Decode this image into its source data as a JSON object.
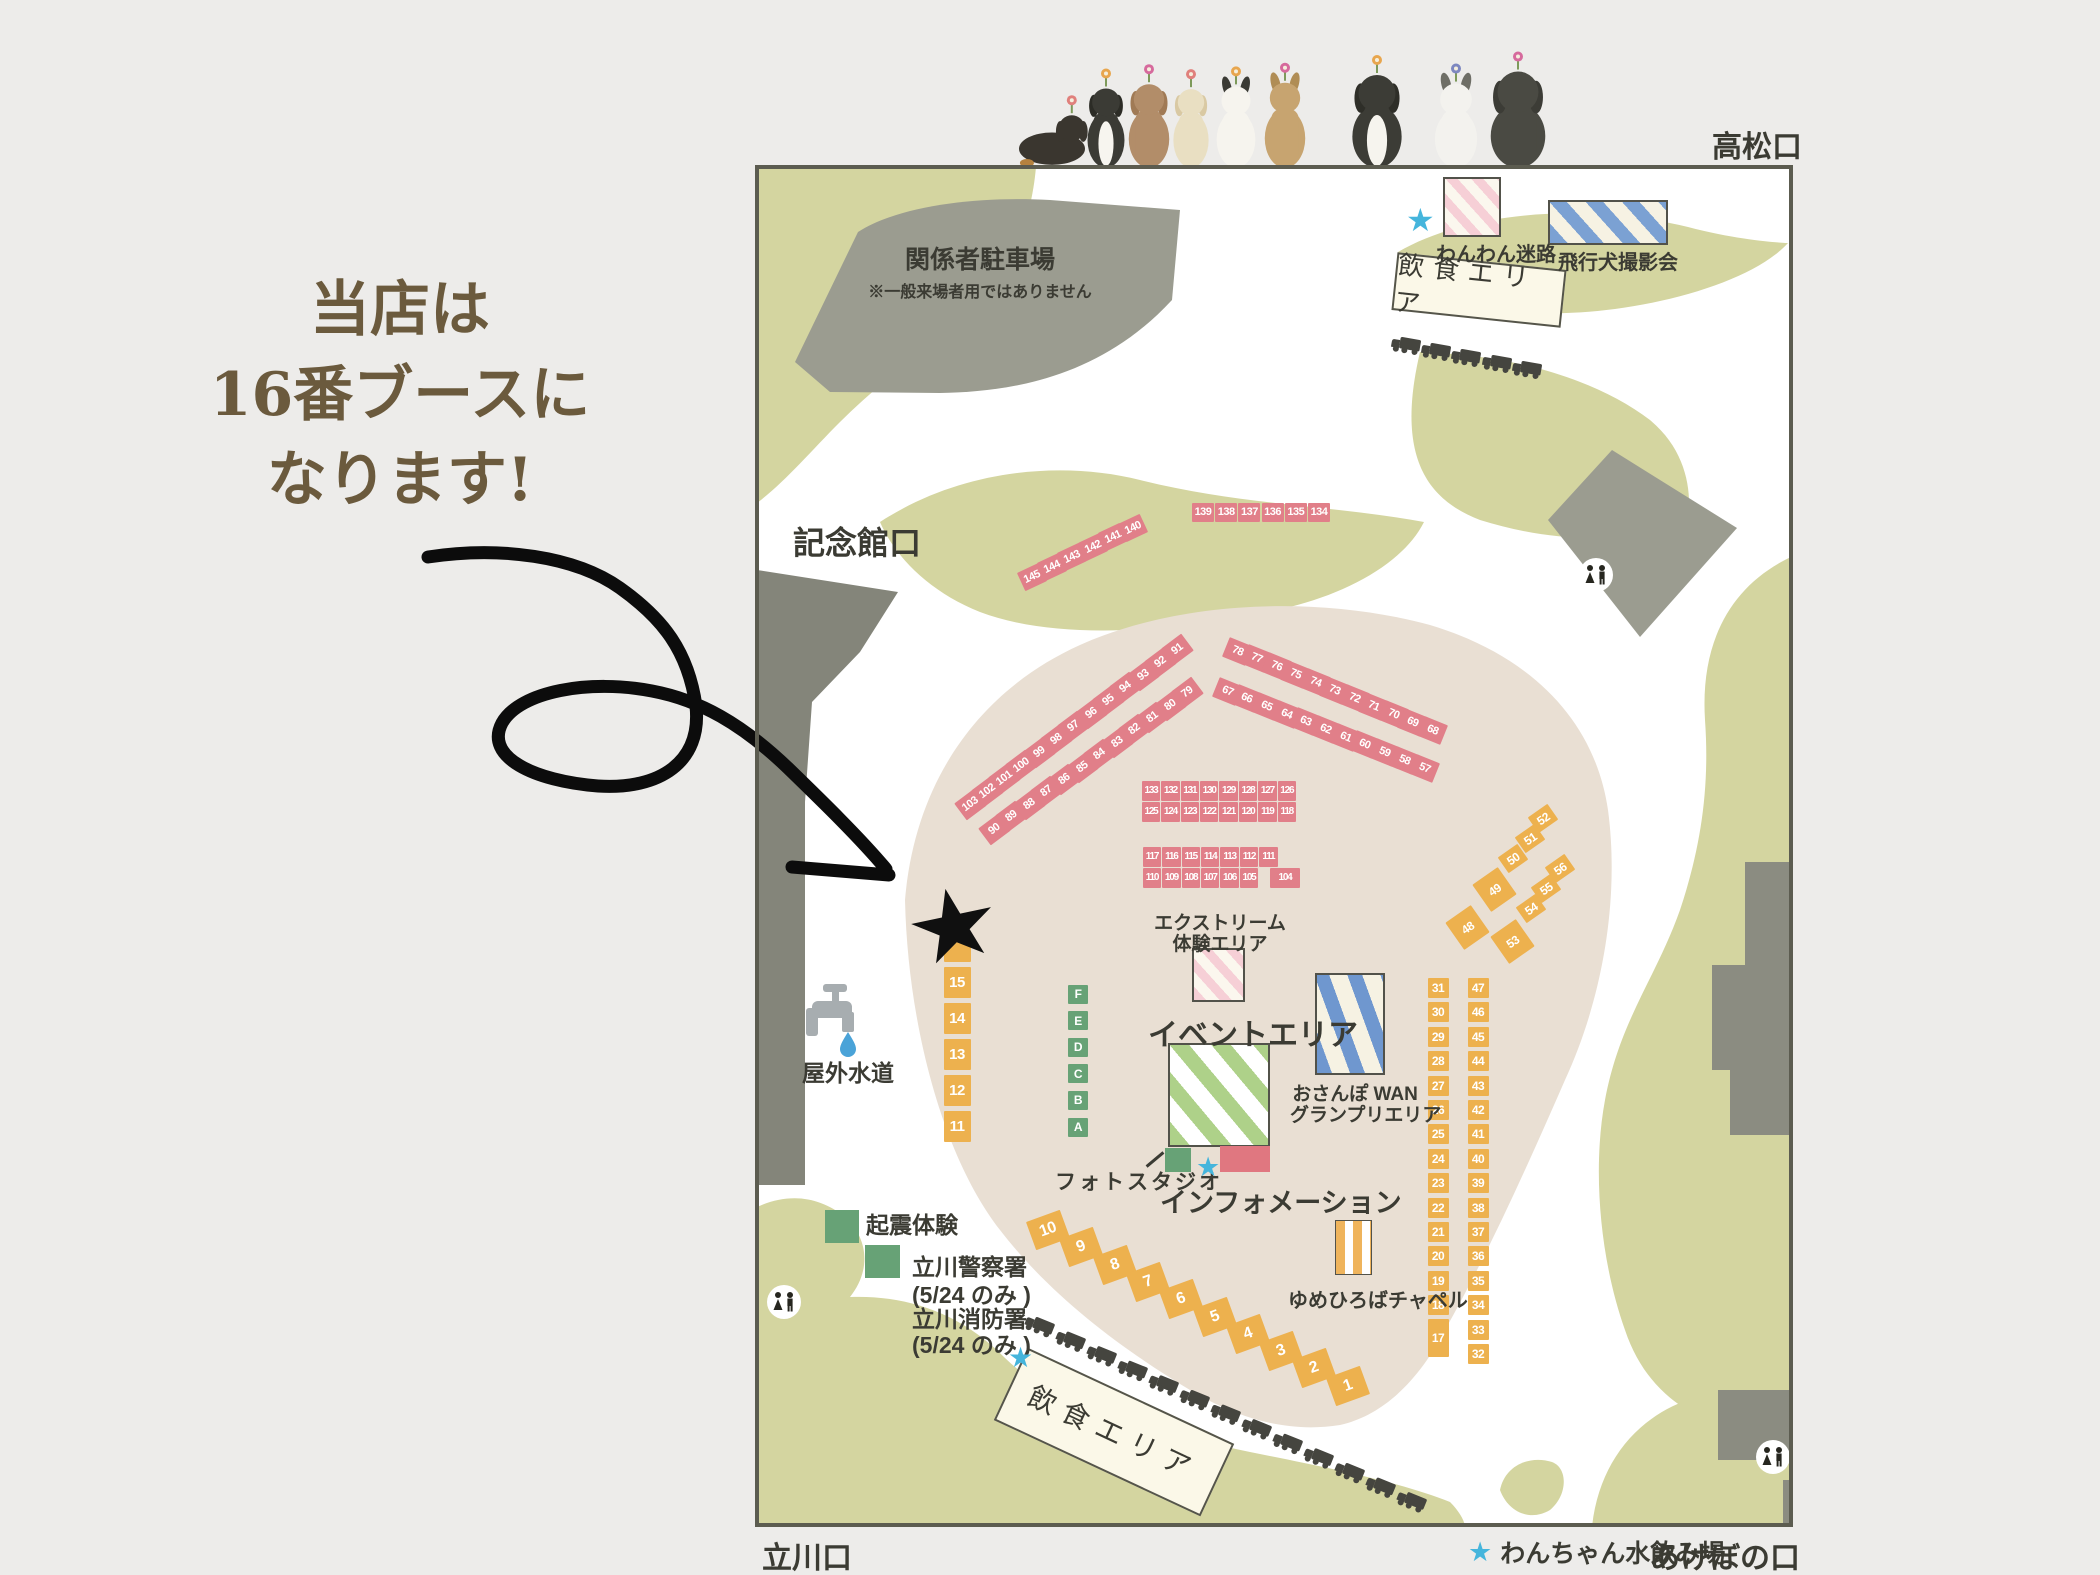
{
  "annotation": {
    "line1": "当店は",
    "line2": "16番ブースに",
    "line3": "なります!"
  },
  "entrances": {
    "top_right": "高松口",
    "left": "記念館口",
    "bottom_left": "立川口",
    "bottom_right": "あけぼの口"
  },
  "legend": {
    "star_label": "わんちゃん水飲み場"
  },
  "areas": {
    "parking_title": "関係者駐車場",
    "parking_note": "※一般来場者用ではありません",
    "maze": "わんわん迷路",
    "flying_dog": "飛行犬撮影会",
    "food_top": "飲食エリア",
    "food_bottom": "飲食エリア",
    "extreme_line1": "エクストリーム",
    "extreme_line2": "体験エリア",
    "event": "イベントエリア",
    "osanpo_line1": "おさんぽ WAN",
    "osanpo_line2": "グランプリエリア",
    "photo": "フォトスタジオ",
    "info": "インフォメーション",
    "chapel": "ゆめひろばチャペル",
    "water": "屋外水道",
    "quake": "起震体験",
    "police_line1": "立川警察署",
    "police_line2": "(5/24 のみ )",
    "fire_line1": "立川消防署",
    "fire_line2": "(5/24 のみ )"
  },
  "booths": {
    "pink": {
      "slant_row": [
        "145",
        "144",
        "143",
        "142",
        "141",
        "140"
      ],
      "top_row": [
        "139",
        "138",
        "137",
        "136",
        "135",
        "134"
      ],
      "left_outer": [
        "103",
        "102",
        "101",
        "100",
        "99",
        "98",
        "97",
        "96",
        "95",
        "94",
        "93",
        "92",
        "91"
      ],
      "left_inner": [
        "90",
        "89",
        "88",
        "87",
        "86",
        "85",
        "84",
        "83",
        "82",
        "81",
        "80",
        "79"
      ],
      "right_outer": [
        "78",
        "77",
        "76",
        "75",
        "74",
        "73",
        "72",
        "71",
        "70",
        "69",
        "68"
      ],
      "right_inner": [
        "67",
        "66",
        "65",
        "64",
        "63",
        "62",
        "61",
        "60",
        "59",
        "58",
        "57"
      ],
      "block1_row1": [
        "133",
        "132",
        "131",
        "130",
        "129",
        "128",
        "127",
        "126"
      ],
      "block1_row2": [
        "125",
        "124",
        "123",
        "122",
        "121",
        "120",
        "119",
        "118"
      ],
      "block2_row1": [
        "117",
        "116",
        "115",
        "114",
        "113",
        "112",
        "111"
      ],
      "block2_row2": [
        "110",
        "109",
        "108",
        "107",
        "106",
        "105",
        "104"
      ]
    },
    "orange": {
      "diag_left": [
        "52",
        "51",
        "50",
        "49",
        "48"
      ],
      "diag_right": [
        "56",
        "55",
        "54",
        "53"
      ],
      "col_inner": [
        "31",
        "30",
        "29",
        "28",
        "27",
        "26",
        "25",
        "24",
        "23",
        "22",
        "21",
        "20",
        "19",
        "18",
        "17"
      ],
      "col_outer": [
        "47",
        "46",
        "45",
        "44",
        "43",
        "42",
        "41",
        "40",
        "39",
        "38",
        "37",
        "36",
        "35",
        "34",
        "33",
        "32"
      ],
      "left_column": [
        "15",
        "14",
        "13",
        "12",
        "11"
      ],
      "bottom_row": [
        "10",
        "9",
        "8",
        "7",
        "6",
        "5",
        "4",
        "3",
        "2",
        "1"
      ],
      "starred_booth": "16"
    },
    "green_letters": [
      "F",
      "E",
      "D",
      "C",
      "B",
      "A"
    ]
  },
  "palette": {
    "paper": "#edecea",
    "grass": "#d4d5a0",
    "plaza": "#e9dfd3",
    "gray_building": "#9b9c90",
    "booth_pink": "#e17f89",
    "booth_orange": "#edb14e",
    "booth_green": "#67a276",
    "info_red": "#e07780",
    "star_black": "#101010",
    "star_blue": "#45b5dc",
    "text_dark": "#3b3b33",
    "text_brown": "#6b5a3d"
  }
}
